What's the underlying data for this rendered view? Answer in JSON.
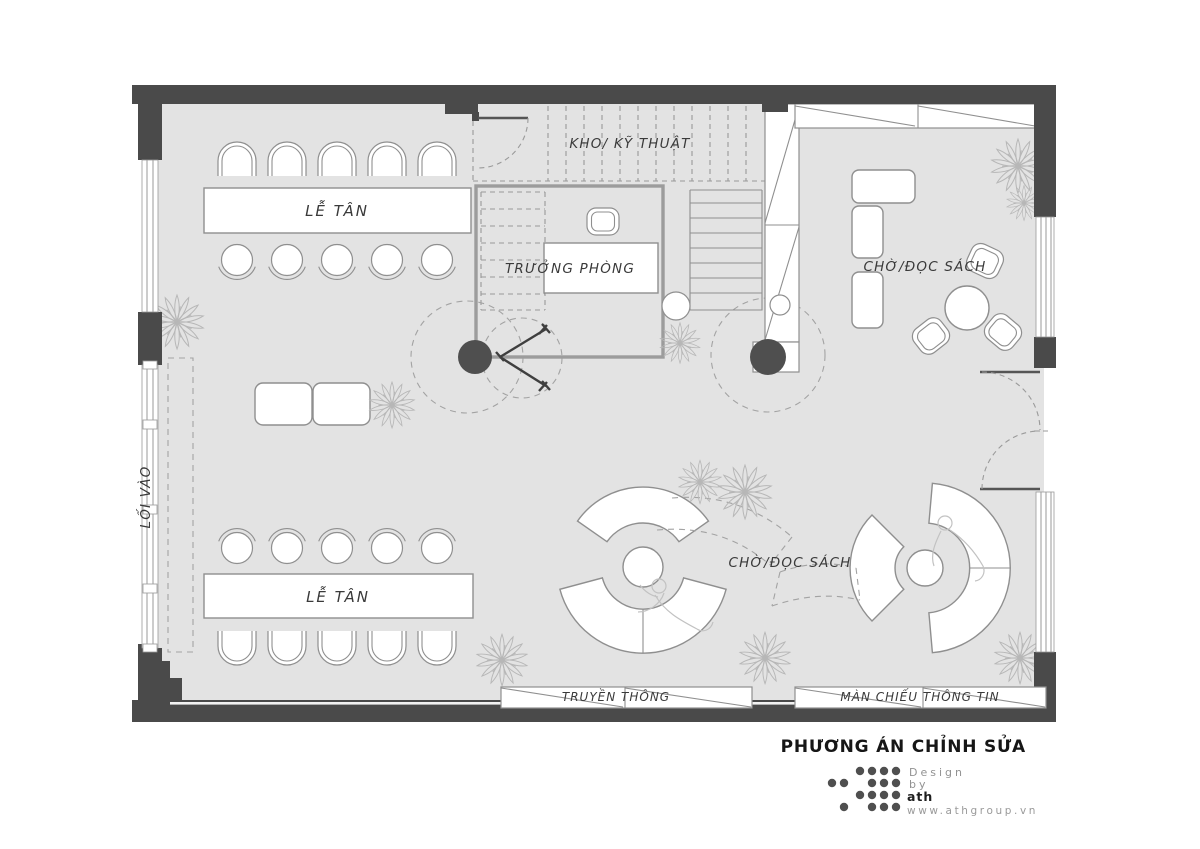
{
  "labels": {
    "storage": "KHO/ KỸ THUẬT",
    "manager": "TRƯỞNG PHÒNG",
    "reception_top": "LỄ TÂN",
    "reception_bottom": "LỄ TÂN",
    "reading_top": "CHỜ/ĐỌC SÁCH",
    "reading_bottom": "CHỜ/ĐỌC SÁCH",
    "entrance": "LỐI VÀO",
    "media": "TRUYỀN THÔNG",
    "info_screen": "MÀN CHIẾU THÔNG TIN"
  },
  "title": "PHƯƠNG ÁN CHỈNH SỬA",
  "credit": {
    "line1": "Design",
    "line2": "by",
    "logo": "ath",
    "website": "www.athgroup.vn"
  },
  "colors": {
    "floor": "#e3e3e3",
    "wall": "#4a4a4a",
    "line": "#8f8f8f",
    "label": "#3a3a3a",
    "dash": "#a3a3a3",
    "plant": "#b7b7b7",
    "sketch": "#c2c2c2",
    "title": "#161616",
    "credit_gray": "#929292",
    "dot": "#4f4f4f"
  }
}
